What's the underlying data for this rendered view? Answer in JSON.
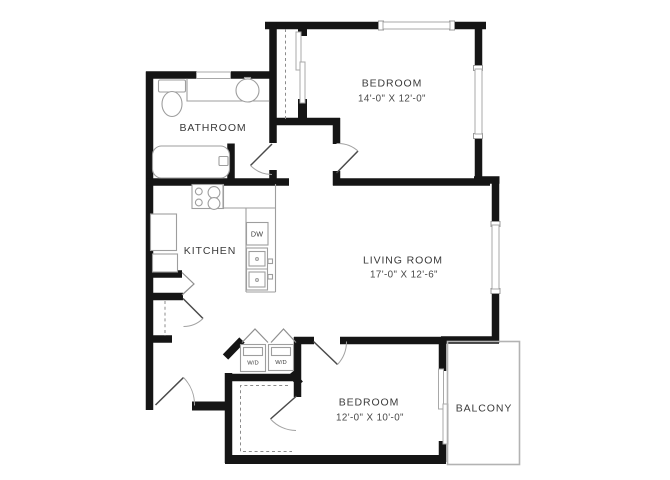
{
  "plan": {
    "rooms": {
      "bedroom1": {
        "name": "BEDROOM",
        "dims": "14'-0\" X 12'-0\""
      },
      "bathroom": {
        "name": "BATHROOM"
      },
      "kitchen": {
        "name": "KITCHEN"
      },
      "living": {
        "name": "LIVING ROOM",
        "dims": "17'-0\" X 12'-6\""
      },
      "bedroom2": {
        "name": "BEDROOM",
        "dims": "12'-0\" X 10'-0\""
      },
      "balcony": {
        "name": "BALCONY"
      }
    },
    "appliances": {
      "dishwasher": "DW",
      "washer_dryer_1": "W/D",
      "washer_dryer_2": "W/D"
    },
    "colors": {
      "wall": "#151515",
      "fixture_outline": "#9e9e9e",
      "dashed_line": "#8c8c8c",
      "label_text": "#3a3a3a",
      "background": "#ffffff"
    }
  }
}
